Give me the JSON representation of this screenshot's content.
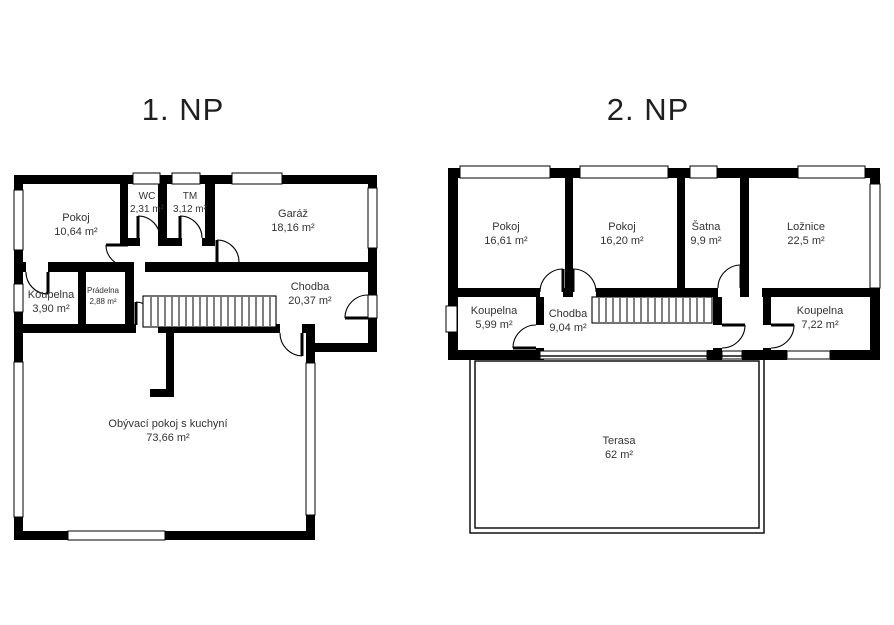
{
  "theme": {
    "wall_color": "#000000",
    "label_color": "#333333",
    "title_color": "#1f1f1f",
    "background": "#ffffff"
  },
  "floors": [
    {
      "title": "1. NP",
      "rooms": [
        {
          "name": "Pokoj",
          "area": "10,64 m²"
        },
        {
          "name": "WC",
          "area": "2,31 m²"
        },
        {
          "name": "TM",
          "area": "3,12 m²"
        },
        {
          "name": "Garáž",
          "area": "18,16 m²"
        },
        {
          "name": "Koupelna",
          "area": "3,90 m²"
        },
        {
          "name": "Prádelna",
          "area": "2,88 m²"
        },
        {
          "name": "Chodba",
          "area": "20,37 m²"
        },
        {
          "name": "Obývací pokoj s kuchyní",
          "area": "73,66 m²"
        }
      ]
    },
    {
      "title": "2. NP",
      "rooms": [
        {
          "name": "Pokoj",
          "area": "16,61 m²"
        },
        {
          "name": "Pokoj",
          "area": "16,20 m²"
        },
        {
          "name": "Šatna",
          "area": "9,9 m²"
        },
        {
          "name": "Ložnice",
          "area": "22,5 m²"
        },
        {
          "name": "Koupelna",
          "area": "5,99 m²"
        },
        {
          "name": "Chodba",
          "area": "9,04 m²"
        },
        {
          "name": "Koupelna",
          "area": "7,22 m²"
        },
        {
          "name": "Terasa",
          "area": "62 m²"
        }
      ]
    }
  ]
}
